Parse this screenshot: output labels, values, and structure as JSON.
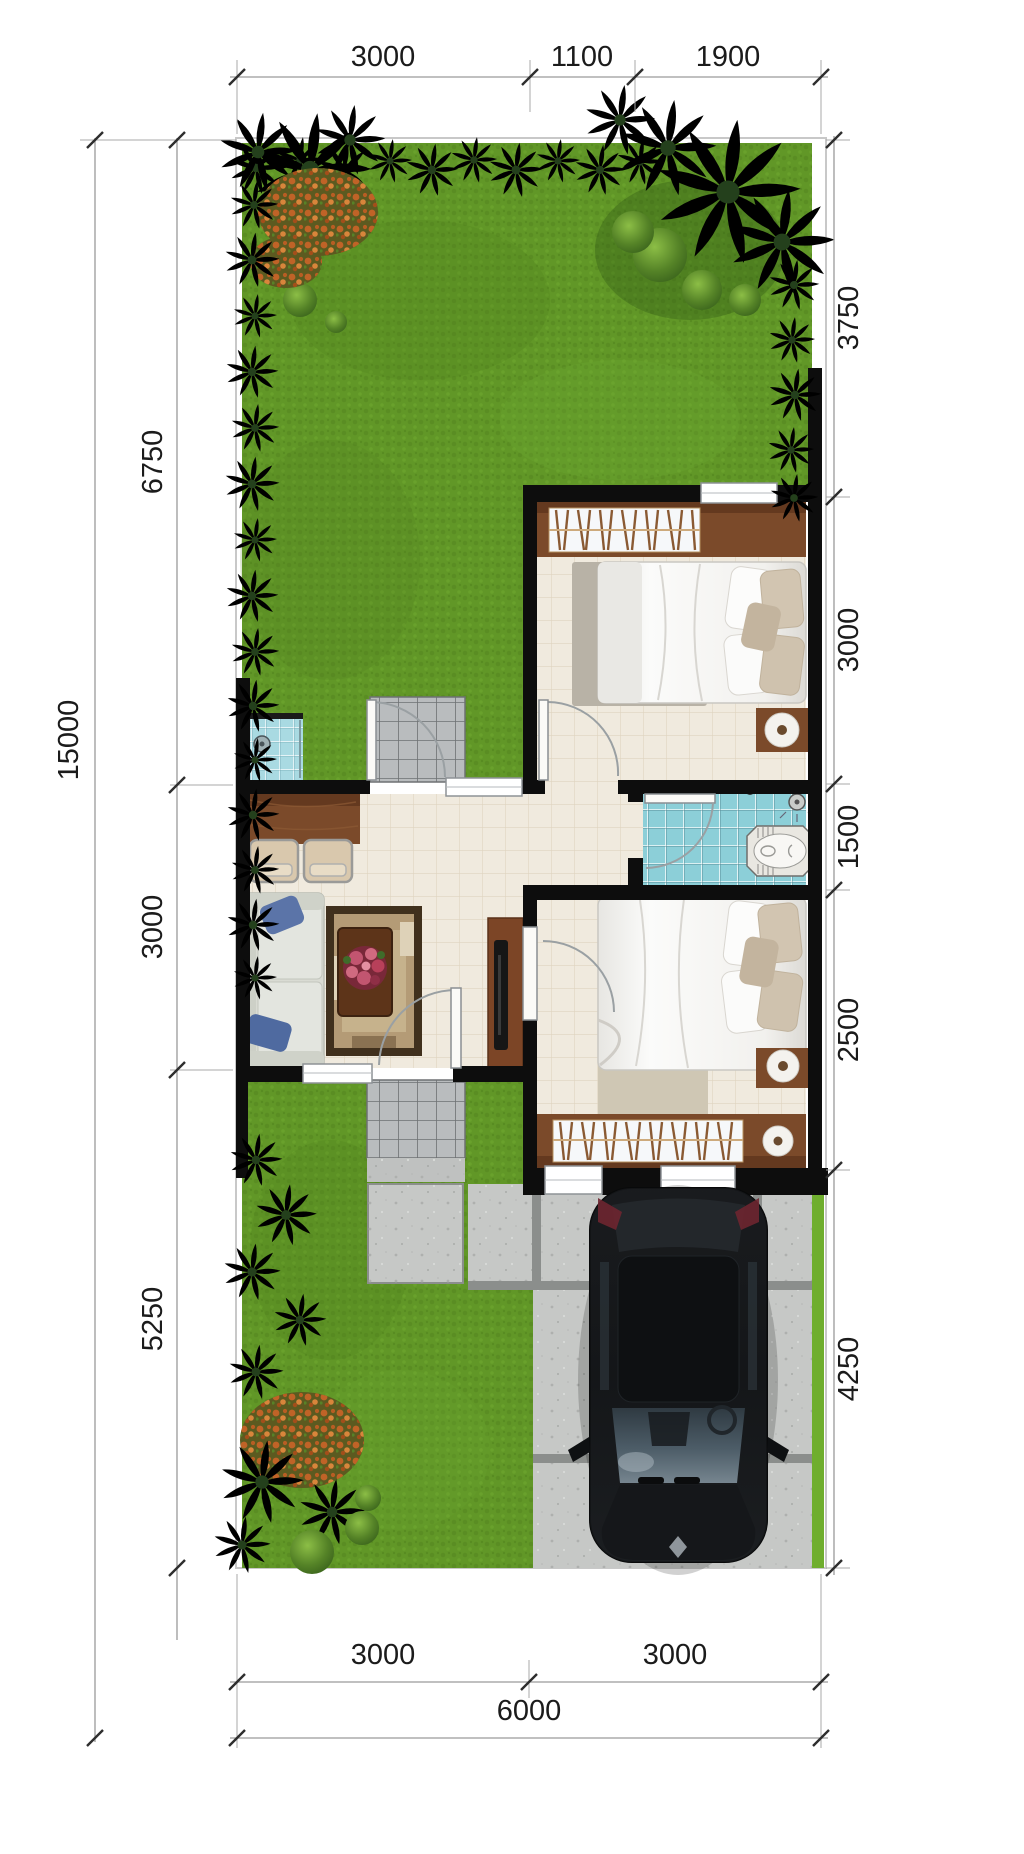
{
  "dimensions": {
    "top": [
      "3000",
      "1100",
      "1900"
    ],
    "left": [
      "6750",
      "3000",
      "5250"
    ],
    "left_total": "15000",
    "right": [
      "3750",
      "3000",
      "1500",
      "2500",
      "4250"
    ],
    "bottom": [
      "3000",
      "3000"
    ],
    "bottom_total": "6000"
  },
  "colors": {
    "grass": "#619727",
    "grass_strip": "#6fae2e",
    "wall": "#0d0d0d",
    "floor": "#f0eade",
    "bath_tile": "#8ccfd8",
    "wash_tile": "#a9dae2",
    "path_tile": "#b9bcbe",
    "concrete": "#c6c8c6",
    "concrete_joint": "#8b8e8c",
    "wood": "#7b4a2a",
    "wood_dark": "#64391f",
    "sofa": "#d9dbd3",
    "cushion_blue": "#5b74a8",
    "car_body": "#17191c",
    "dim_text": "#1b1b1b"
  },
  "icons": {
    "shower_head": "circle-with-spray-dots",
    "ceiling_disc": "white-disc-with-brown-hub",
    "flower_bouquet": "pink-red-cluster",
    "car_logo": "silver-diamond"
  }
}
